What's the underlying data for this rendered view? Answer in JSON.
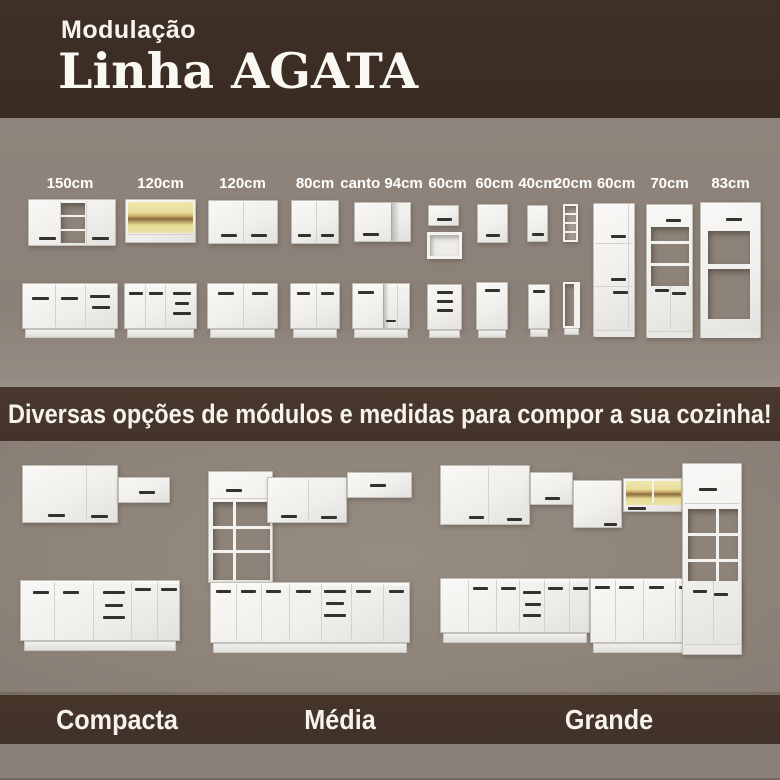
{
  "header": {
    "subtitle": "Modulação",
    "title": "Linha AGATA"
  },
  "modules": {
    "items": [
      {
        "label": "150cm",
        "kind": "wall-2-door-open-shelf-and-base-2-door-drawers"
      },
      {
        "label": "120cm",
        "kind": "wall-glass-door-and-base-2-door-3-drawers"
      },
      {
        "label": "120cm",
        "kind": "wall-2-door-and-base-2-door"
      },
      {
        "label": "80cm",
        "kind": "wall-2-door-and-base-2-door"
      },
      {
        "label": "canto 94cm",
        "kind": "corner-wall-and-corner-base"
      },
      {
        "label": "60cm",
        "kind": "wall-flip-door-open-box-and-base-3-drawers"
      },
      {
        "label": "60cm",
        "kind": "wall-1-door-and-base-1-door"
      },
      {
        "label": "40cm",
        "kind": "wall-1-door-and-base-1-door"
      },
      {
        "label": "20cm",
        "kind": "open-niche-tower-and-base-niche"
      },
      {
        "label": "60cm",
        "kind": "tall-pantry-cabinet"
      },
      {
        "label": "70cm",
        "kind": "tall-open-shelf-cabinet-2-doors"
      },
      {
        "label": "83cm",
        "kind": "tall-appliance-surround"
      }
    ]
  },
  "tagline": {
    "text": "Diversas opções de módulos e medidas para compor a sua cozinha!"
  },
  "kitchens": {
    "items": [
      {
        "label": "Compacta"
      },
      {
        "label": "Média"
      },
      {
        "label": "Grande"
      }
    ]
  },
  "palette": {
    "header_bg": "#3a2c22",
    "band_bg": "#45342a",
    "modules_bg": "#8b8178",
    "kitchens_bg": "#8e847a",
    "bottom_strip": "#8a8077",
    "cabinet_white": "#f2f1ee",
    "glass_interior": "#e7dc9a",
    "glass_wood": "#8a6d3f",
    "handle": "#34322e",
    "text": "#ffffff"
  }
}
